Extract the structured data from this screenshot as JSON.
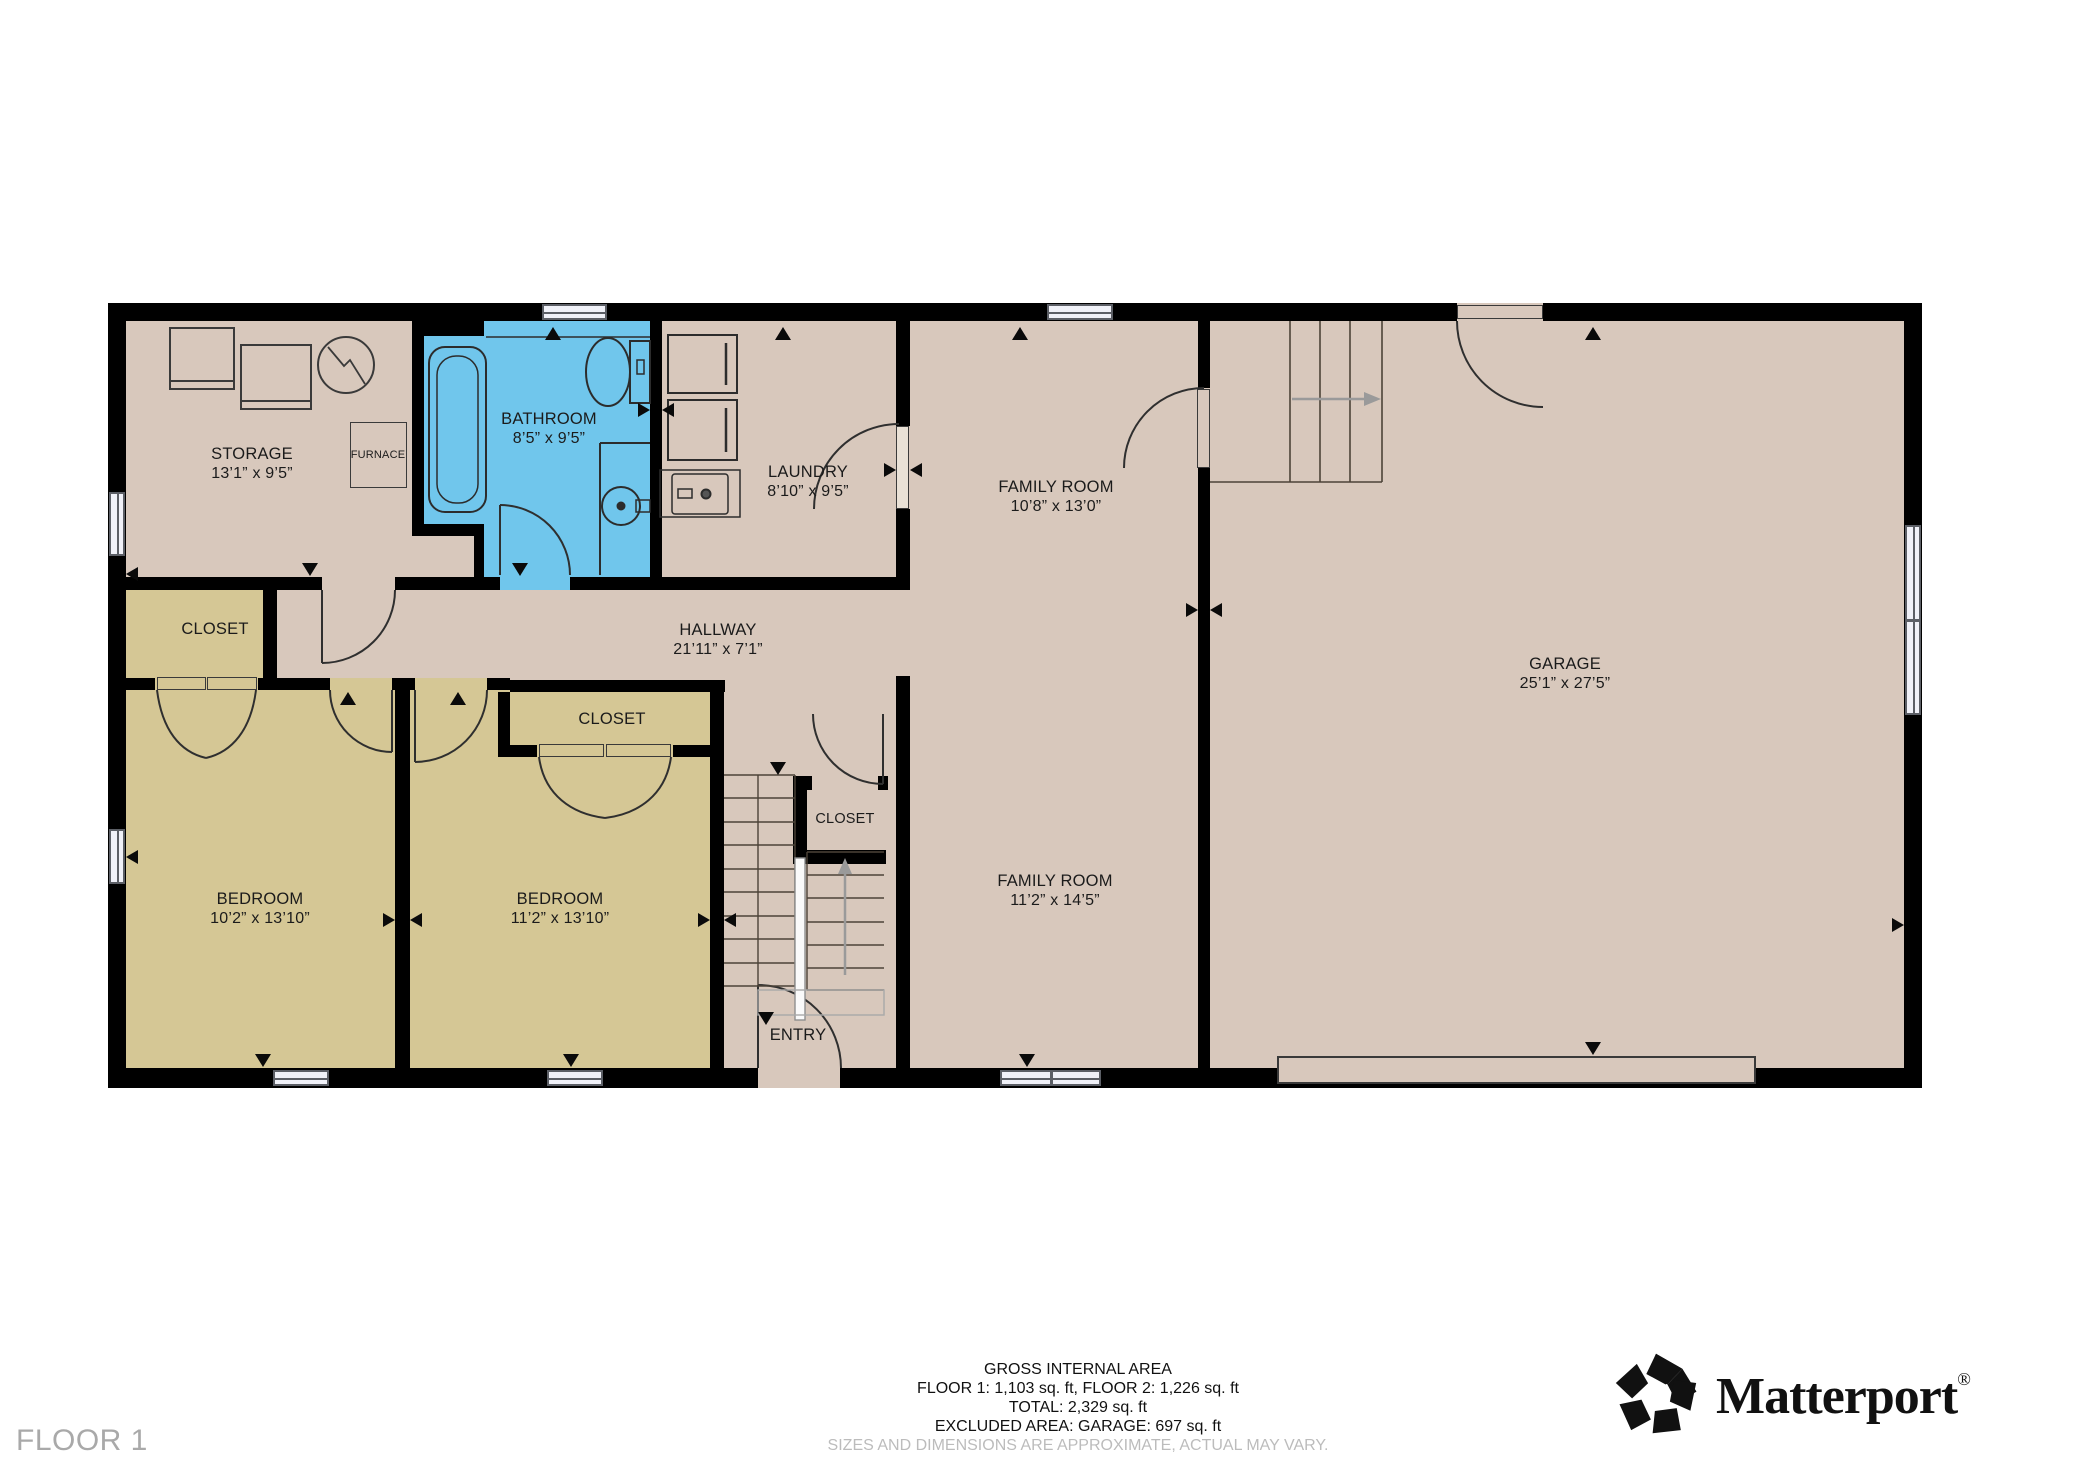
{
  "floor_label": "FLOOR 1",
  "colors": {
    "wall": "#000000",
    "floor": "#d8c8bc",
    "bedroom": "#d5c795",
    "bathroom": "#70c6ec",
    "window": "#f0f1f8",
    "stair_arrow": "#9a9a9a",
    "label_text": "#1b1b1b",
    "muted_text": "#a9a9a9"
  },
  "rooms": {
    "storage": {
      "name": "STORAGE",
      "dims": "13’1” x 9’5”"
    },
    "furnace": {
      "name": "FURNACE"
    },
    "bathroom": {
      "name": "BATHROOM",
      "dims": "8’5” x 9’5”"
    },
    "laundry": {
      "name": "LAUNDRY",
      "dims": "8’10” x 9’5”"
    },
    "family_room_upper": {
      "name": "FAMILY ROOM",
      "dims": "10’8” x 13’0”"
    },
    "hallway": {
      "name": "HALLWAY",
      "dims": "21’11” x 7’1”"
    },
    "garage": {
      "name": "GARAGE",
      "dims": "25’1” x 27’5”"
    },
    "closet_left": {
      "name": "CLOSET"
    },
    "closet_bedroom2": {
      "name": "CLOSET"
    },
    "closet_center": {
      "name": "CLOSET"
    },
    "bedroom_left": {
      "name": "BEDROOM",
      "dims": "10’2” x 13’10”"
    },
    "bedroom_right": {
      "name": "BEDROOM",
      "dims": "11’2” x 13’10”"
    },
    "family_room_lower": {
      "name": "FAMILY ROOM",
      "dims": "11’2” x 14’5”"
    },
    "entry": {
      "name": "ENTRY"
    }
  },
  "summary": {
    "title": "GROSS INTERNAL AREA",
    "floors": "FLOOR 1: 1,103 sq. ft, FLOOR 2: 1,226 sq. ft",
    "total": "TOTAL: 2,329 sq. ft",
    "excluded": "EXCLUDED AREA: GARAGE: 697 sq. ft",
    "disclaimer": "SIZES AND DIMENSIONS ARE APPROXIMATE, ACTUAL MAY VARY."
  },
  "branding": {
    "name": "Matterport",
    "registered": "®",
    "icon": "matterport-pinwheel-icon"
  }
}
